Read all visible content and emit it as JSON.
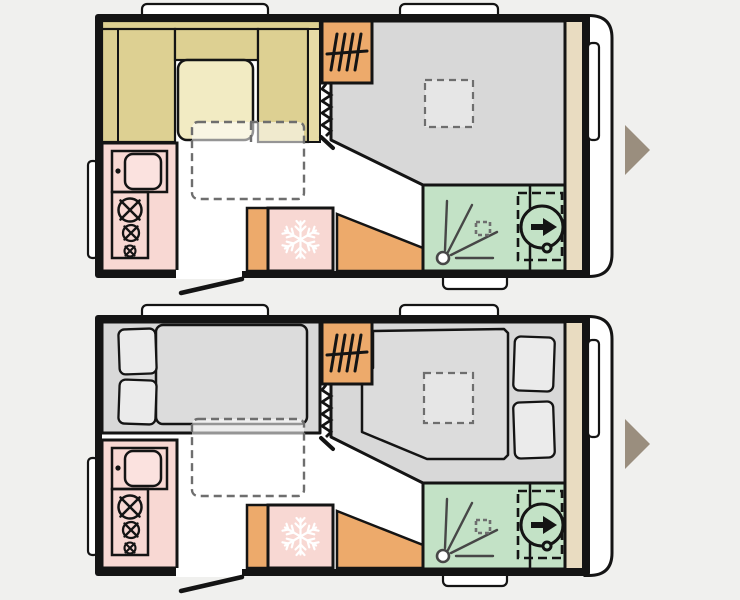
{
  "page": {
    "background": "#f0f0ee",
    "description": "Caravan floorplan diagrams, day layout (top) and night layout (bottom)"
  },
  "colors": {
    "background": "#f0f0ee",
    "wall": "#141414",
    "white": "#ffffff",
    "floorGray": "#d8d8d8",
    "seat": "#ddd092",
    "seatSide": "#e7dca6",
    "table": "#f2ebc3",
    "orange": "#edaa6b",
    "pinkKitchen": "#f8d8d3",
    "pinkSink": "#fbe2df",
    "green": "#c3e2c6",
    "stripTan": "#e9dcc1",
    "arrow": "#9a8e7e",
    "mattress": "#dcdcdc",
    "pillow": "#ebebeb",
    "skylight": "#e6e6e6",
    "dash": "#6e6e6e",
    "ray": "#474747"
  },
  "plans": [
    {
      "id": "day-layout",
      "features": [
        "dinette-seating",
        "dinette-table",
        "bed-conversion-outline",
        "wardrobe-with-rail",
        "concertina-partition",
        "skylight",
        "living-area-floor",
        "kitchen-sink",
        "hob-3-burner",
        "fridge",
        "entrance-door",
        "shower",
        "toilet",
        "overhead-strip",
        "front-window",
        "side-window",
        "roof-windows"
      ]
    },
    {
      "id": "night-layout",
      "features": [
        "rear-double-bed",
        "pillows",
        "bed-conversion-outline",
        "wardrobe-with-rail",
        "concertina-partition",
        "skylight",
        "front-double-bed",
        "kitchen-sink",
        "hob-3-burner",
        "fridge",
        "entrance-door",
        "shower",
        "toilet",
        "overhead-strip",
        "front-window",
        "side-window",
        "roof-windows"
      ]
    }
  ],
  "navigation": {
    "next_arrow_glyph": "▶",
    "arrow_count": 2
  }
}
